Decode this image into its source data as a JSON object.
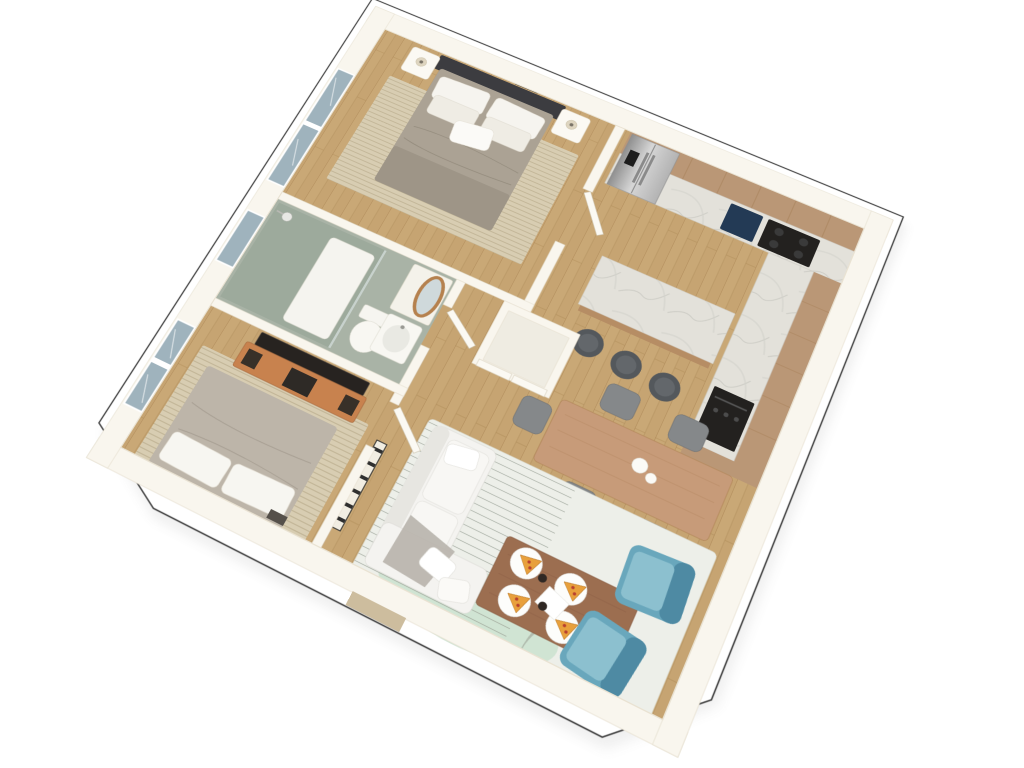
{
  "scene": {
    "description": "3D isometric top-down render of a two-bedroom apartment floor plan on a white background",
    "view": "rotated bird's-eye 3D render",
    "rooms": [
      {
        "name": "bedroom-1",
        "location": "top-left",
        "furniture": [
          "double-bed",
          "dark-headboard",
          "white-pillows",
          "nightstand-left",
          "nightstand-right",
          "table-lamps",
          "six-wall-picture-frames",
          "beige-area-rug",
          "window"
        ]
      },
      {
        "name": "bathroom",
        "location": "middle-left",
        "furniture": [
          "walk-in-shower",
          "glass-partition",
          "shower-head",
          "shower-tray",
          "toilet",
          "vanity-sink",
          "oval-wood-mirror",
          "window"
        ]
      },
      {
        "name": "bedroom-2",
        "location": "bottom-left",
        "furniture": [
          "double-bed",
          "white-pillows",
          "beige-area-rug",
          "flatscreen-tv",
          "orange-wood-tv-console",
          "speakers",
          "window"
        ]
      },
      {
        "name": "closet",
        "location": "center",
        "furniture": [
          "double-door-wardrobe"
        ]
      },
      {
        "name": "hallway",
        "location": "center",
        "furniture": [
          "ladder-shelf",
          "bathroom-door",
          "bedroom-doors"
        ]
      },
      {
        "name": "kitchen",
        "location": "top-right",
        "furniture": [
          "upper-tan-cabinets",
          "marble-counter",
          "fridge-freezer",
          "navy-sink",
          "black-cooktop",
          "wall-oven",
          "marble-island-bar",
          "three-bar-stools"
        ]
      },
      {
        "name": "dining-area",
        "location": "right",
        "furniture": [
          "wood-dining-table",
          "five-gray-chairs",
          "white-centerpiece-cups"
        ]
      },
      {
        "name": "living-room",
        "location": "bottom-center",
        "furniture": [
          "white-sofa",
          "throw-pillows",
          "gray-throw-blanket",
          "striped-green-rug",
          "wood-coffee-table",
          "four-pizza-plates",
          "coffee-cups",
          "serving-bowl",
          "two-teal-armchairs",
          "entry-door-mat"
        ]
      }
    ]
  },
  "colors": {
    "background": "#ffffff",
    "outline": "#4a4a4a",
    "wall": "#f9f6ee",
    "wallEdge": "#e6dfcf",
    "closetFloor": "#efece2",
    "wood": "#c9a876",
    "tileBath": "#a9b3a6",
    "showerTile": "#9daa9c",
    "cabinetTan": "#ba9776",
    "fridgeSilver": "#c4c4c4",
    "applianceBlack": "#23211f",
    "sinkNavy": "#233a55",
    "islandBase": "#b68d64",
    "stoolGray": "#54585c",
    "diningTable": "#c79b79",
    "chairGray": "#85888a",
    "sofaWhite": "#f4f3f0",
    "coffeeTable": "#9c6e50",
    "armchairTeal": "#69a7bc",
    "armchairTealDark": "#4e8aa3",
    "rugLiving": "#edefe9",
    "rugGreen": "#cfe3d2",
    "rugBeige": "#d8cdb2",
    "bed1Duvet": "#aba294",
    "bed2Duvet": "#bdb5a9",
    "headboard": "#3c3c40",
    "consoleWood": "#c8824e",
    "windowGlass": "#9fb3bd",
    "doorLeaf": "#fbf9f3",
    "doorMat": "#cdbd9e",
    "pizza": "#e8a03c",
    "pepperoni": "#b8402f"
  }
}
